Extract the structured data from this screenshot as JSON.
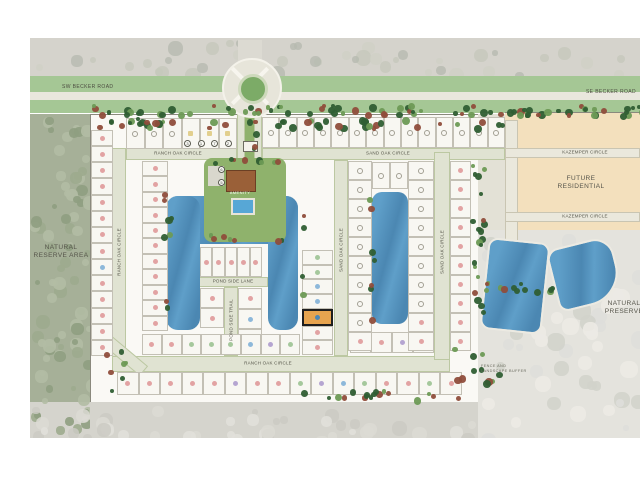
{
  "labels": {
    "sw_becker": "SW BECKER ROAD",
    "se_becker": "SE BECKER ROAD",
    "natural_reserve_1": "NATURAL",
    "natural_reserve_2": "RESERVE AREA",
    "future_residential_1": "FUTURE",
    "future_residential_2": "RESIDENTIAL",
    "natural_preserve_1": "NATURAL",
    "natural_preserve_2": "PRESERVE",
    "amenity": "AMENITY",
    "fence_note_1": "FENCE AND",
    "fence_note_2": "LANDSCAPE BUFFER"
  },
  "street_labels": [
    {
      "name": "RANCH OAK CIRCLE",
      "x": 178,
      "y": 153,
      "rot": 0
    },
    {
      "name": "RANCH OAK CIRCLE",
      "x": 119,
      "y": 252,
      "rot": -90
    },
    {
      "name": "RANCH OAK CIRCLE",
      "x": 268,
      "y": 363,
      "rot": 0
    },
    {
      "name": "SAND OAK CIRCLE",
      "x": 388,
      "y": 153,
      "rot": 0
    },
    {
      "name": "SAND OAK CIRCLE",
      "x": 341,
      "y": 250,
      "rot": -90
    },
    {
      "name": "SAND OAK CIRCLE",
      "x": 442,
      "y": 252,
      "rot": -90
    },
    {
      "name": "POND SIDE LANE",
      "x": 233,
      "y": 281,
      "rot": 0
    },
    {
      "name": "POND SIDE TRAIL",
      "x": 231,
      "y": 320,
      "rot": -90
    },
    {
      "name": "KAZEMPER CIRCLE",
      "x": 585,
      "y": 152,
      "rot": 0
    },
    {
      "name": "KAZEMPER CIRCLE",
      "x": 585,
      "y": 216,
      "rot": 0
    }
  ],
  "keyed_notes": {
    "entrance": [
      "3",
      "1",
      "7",
      "2"
    ],
    "amenity": [
      "6",
      "5"
    ]
  },
  "colors": {
    "water": "#5f9fc9",
    "water_deep": "#4b87b2",
    "dot_pink": "#e2a3a3",
    "dot_blue": "#8db8da",
    "dot_green": "#a5c89c",
    "dot_purple": "#b5a5d1",
    "dot_yellow": "#e2cf8e",
    "ring": "#a29f93",
    "highlight_fill": "#e7a44f",
    "highlight_border": "#1e1e1e",
    "selected_dot": "#4d87b5"
  },
  "lot_groups": [
    {
      "id": "row-top-left",
      "dir": "h",
      "x": 126,
      "y": 118,
      "w": 111,
      "h": 31,
      "lots": [
        "ring",
        "ring",
        "ring",
        "yellow",
        "yellow",
        "yellow"
      ]
    },
    {
      "id": "row-top-right",
      "dir": "h",
      "x": 262,
      "y": 117,
      "w": 243,
      "h": 31,
      "lots": [
        "ring",
        "ring",
        "ring",
        "ring",
        "ring",
        "ring",
        "ring",
        "ring",
        "ring",
        "ring",
        "ring",
        "ring",
        "ring",
        "ring"
      ]
    },
    {
      "id": "col-west-outer",
      "dir": "v",
      "x": 91,
      "y": 130,
      "w": 22,
      "h": 226,
      "lots": [
        "pink",
        "pink",
        "pink",
        "pink",
        "pink",
        "pink",
        "pink",
        "pink",
        "blue",
        "pink",
        "pink",
        "pink",
        "pink",
        "pink"
      ]
    },
    {
      "id": "col-west-inner",
      "dir": "v",
      "x": 142,
      "y": 161,
      "w": 26,
      "h": 170,
      "lots": [
        "pink",
        "pink",
        "pink",
        "pink",
        "pink",
        "pink",
        "pink",
        "pink",
        "pink",
        "pink",
        "pink"
      ]
    },
    {
      "id": "row-u-top",
      "dir": "h",
      "x": 200,
      "y": 247,
      "w": 62,
      "h": 30,
      "lots": [
        "pink",
        "pink",
        "pink",
        "pink",
        "pink"
      ]
    },
    {
      "id": "col-u-left",
      "dir": "v",
      "x": 200,
      "y": 288,
      "w": 24,
      "h": 40,
      "lots": [
        "pink",
        "pink"
      ]
    },
    {
      "id": "col-u-right",
      "dir": "v",
      "x": 238,
      "y": 288,
      "w": 24,
      "h": 62,
      "lots": [
        "pink",
        "blue",
        "purple"
      ]
    },
    {
      "id": "col-east-arm",
      "dir": "v",
      "x": 302,
      "y": 250,
      "w": 31,
      "h": 105,
      "highlight": 4,
      "lots": [
        "green",
        "green",
        "blue",
        "blue",
        "blue",
        "pink",
        "pink"
      ]
    },
    {
      "id": "row-inner-bottom",
      "dir": "h",
      "x": 142,
      "y": 334,
      "w": 158,
      "h": 21,
      "lots": [
        "pink",
        "pink",
        "green",
        "green",
        "green",
        "blue",
        "purple",
        "green"
      ]
    },
    {
      "id": "row-inner-bottom-e",
      "dir": "h",
      "x": 350,
      "y": 332,
      "w": 84,
      "h": 21,
      "lots": [
        "pink",
        "pink",
        "purple",
        "pink"
      ]
    },
    {
      "id": "row-eastlake-top",
      "dir": "h",
      "x": 372,
      "y": 162,
      "w": 36,
      "h": 27,
      "lots": [
        "ring",
        "ring"
      ]
    },
    {
      "id": "col-eastlake-west",
      "dir": "v",
      "x": 348,
      "y": 161,
      "w": 24,
      "h": 190,
      "lots": [
        "ring",
        "ring",
        "ring",
        "ring",
        "ring",
        "ring",
        "ring",
        "ring",
        "ring",
        "pink"
      ]
    },
    {
      "id": "col-eastlake-east",
      "dir": "v",
      "x": 408,
      "y": 161,
      "w": 26,
      "h": 190,
      "lots": [
        "ring",
        "ring",
        "ring",
        "ring",
        "ring",
        "ring",
        "ring",
        "ring",
        "pink",
        "pink"
      ]
    },
    {
      "id": "col-east-outer",
      "dir": "v",
      "x": 450,
      "y": 161,
      "w": 21,
      "h": 190,
      "lots": [
        "pink",
        "pink",
        "pink",
        "pink",
        "pink",
        "pink",
        "pink",
        "pink",
        "pink",
        "pink"
      ]
    },
    {
      "id": "row-south-outer",
      "dir": "h",
      "x": 117,
      "y": 372,
      "w": 345,
      "h": 23,
      "lots": [
        "pink",
        "pink",
        "pink",
        "pink",
        "pink",
        "purple",
        "pink",
        "pink",
        "green",
        "purple",
        "blue",
        "green",
        "pink",
        "pink",
        "green",
        "pink"
      ]
    }
  ]
}
